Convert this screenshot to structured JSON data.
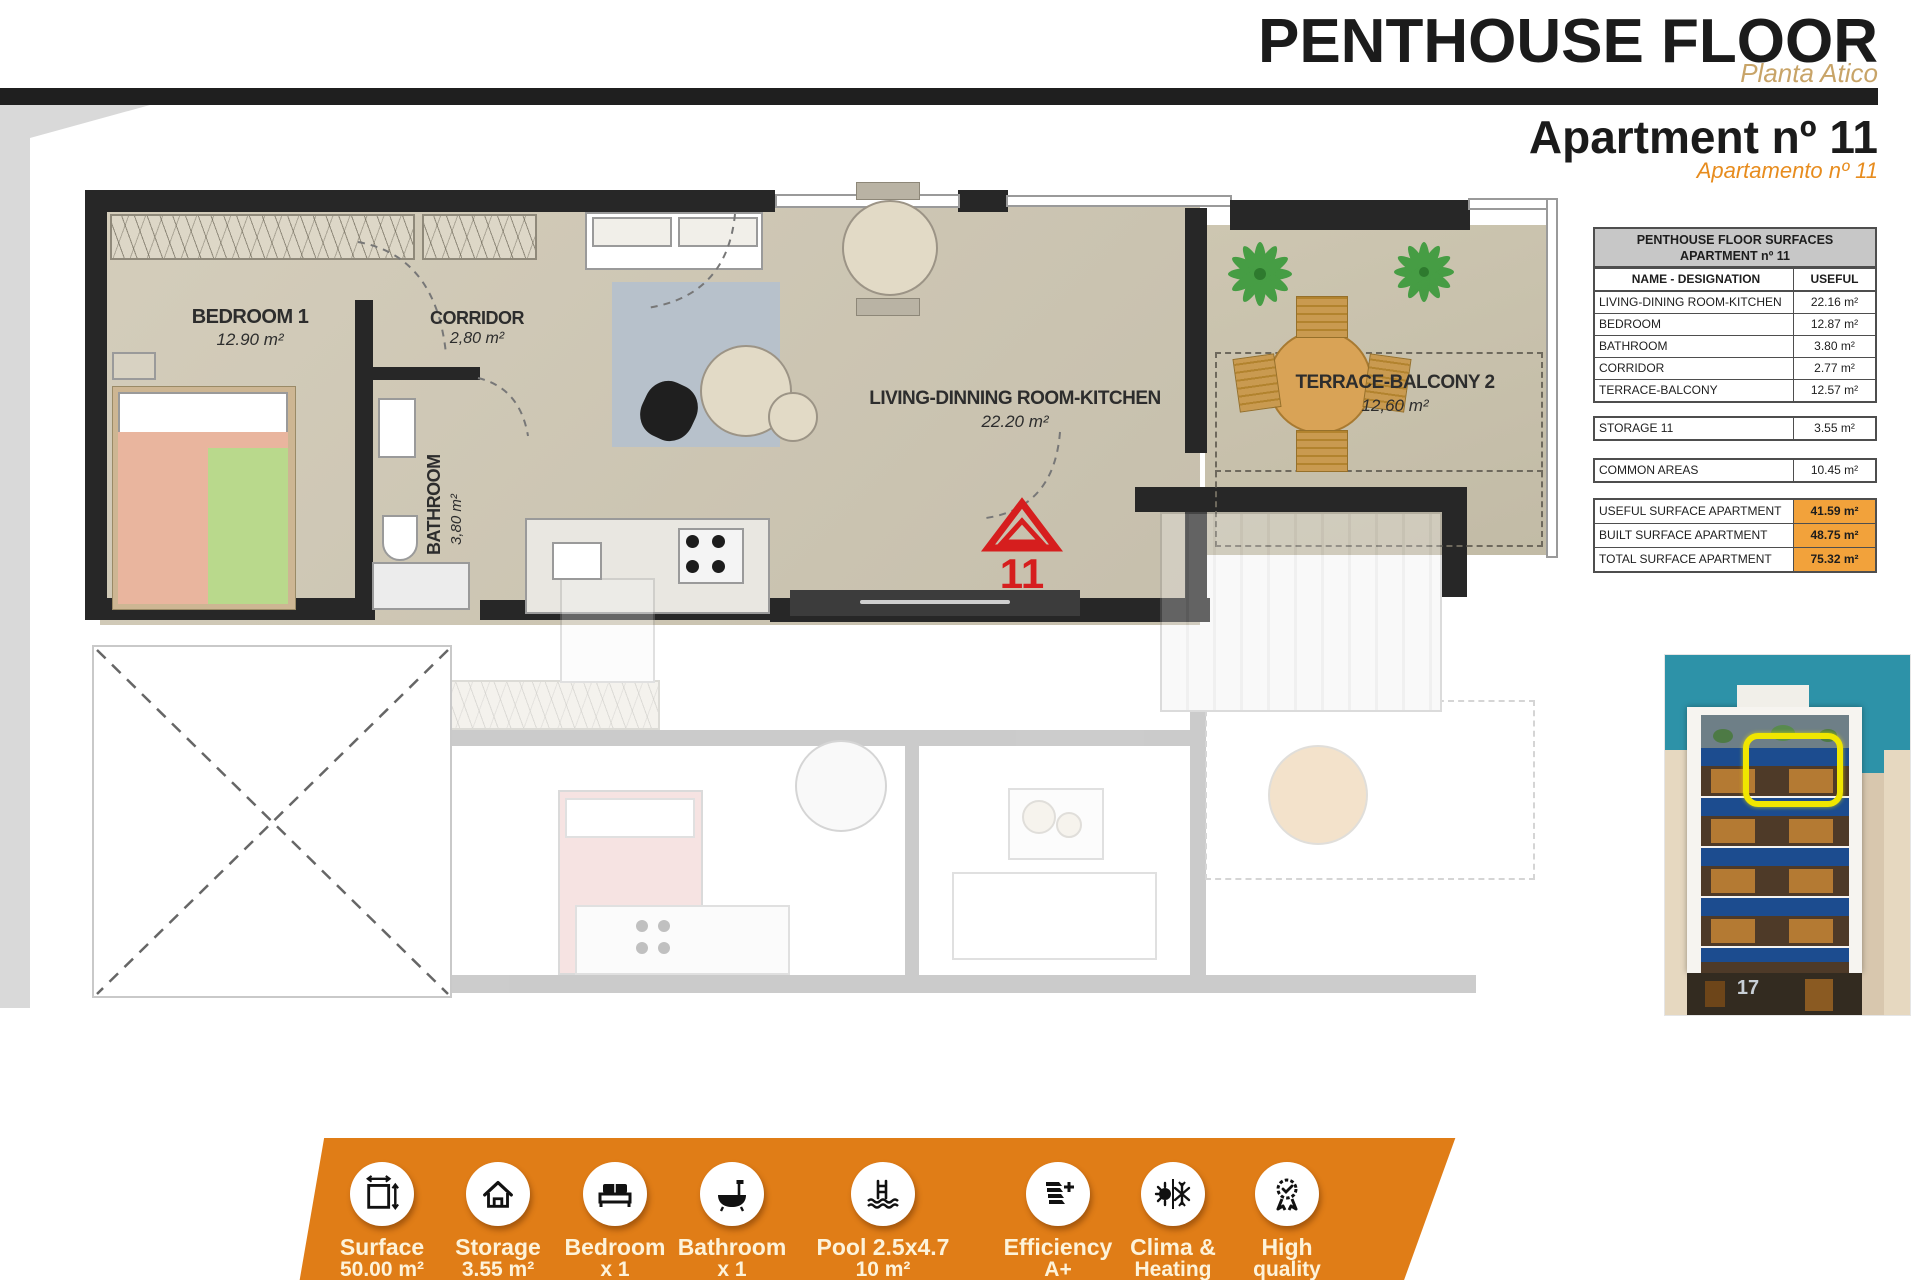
{
  "header": {
    "title": "PENTHOUSE FLOOR",
    "subtitle": "Planta Atico",
    "apartment_title": "Apartment nº 11",
    "apartment_subtitle": "Apartamento nº 11"
  },
  "floor_plan": {
    "rooms": [
      {
        "name": "BEDROOM 1",
        "area": "12.90 m²"
      },
      {
        "name": "CORRIDOR",
        "area": "2,80 m²"
      },
      {
        "name": "BATHROOM",
        "area": "3,80 m²"
      },
      {
        "name": "LIVING-DINNING ROOM-KITCHEN",
        "area": "22.20 m²"
      },
      {
        "name": "TERRACE-BALCONY 2",
        "area": "12,60 m²"
      }
    ],
    "entrance_marker": "11"
  },
  "surfaces_table": {
    "title_line1": "PENTHOUSE FLOOR SURFACES",
    "title_line2": "APARTMENT nº 11",
    "col_name": "NAME - DESIGNATION",
    "col_useful": "USEFUL",
    "rows": [
      {
        "name": "LIVING-DINING ROOM-KITCHEN",
        "value": "22.16 m²"
      },
      {
        "name": "BEDROOM",
        "value": "12.87 m²"
      },
      {
        "name": "BATHROOM",
        "value": "3.80 m²"
      },
      {
        "name": "CORRIDOR",
        "value": "2.77 m²"
      },
      {
        "name": "TERRACE-BALCONY",
        "value": "12.57 m²"
      }
    ],
    "storage_row": {
      "name": "STORAGE 11",
      "value": "3.55 m²"
    },
    "common_row": {
      "name": "COMMON AREAS",
      "value": "10.45 m²"
    },
    "summary_rows": [
      {
        "name": "USEFUL SURFACE APARTMENT",
        "value": "41.59 m²"
      },
      {
        "name": "BUILT SURFACE APARTMENT",
        "value": "48.75 m²"
      },
      {
        "name": "TOTAL SURFACE APARTMENT",
        "value": "75.32 m²"
      }
    ]
  },
  "building": {
    "street_number": "17"
  },
  "banner": {
    "items": [
      {
        "label": "Surface",
        "value": "50.00 m²"
      },
      {
        "label": "Storage",
        "value": "3.55 m²"
      },
      {
        "label": "Bedroom",
        "value": "x 1"
      },
      {
        "label": "Bathroom",
        "value": "x 1"
      },
      {
        "label": "Pool 2.5x4.7",
        "value": "10 m²"
      },
      {
        "label": "Efficiency",
        "value": "A+"
      },
      {
        "label": "Clima &",
        "value": "Heating"
      },
      {
        "label": "High",
        "value": "quality"
      }
    ]
  },
  "colors": {
    "accent_orange": "#e78c1e",
    "table_orange": "#f2a23b",
    "banner_orange": "#e07d17",
    "marker_red": "#d61e1e",
    "subtitle_tan": "#c8a468",
    "awning_blue": "#1c4c8f",
    "sky_teal": "#2d92a8",
    "highlight_yellow": "#f0e600"
  }
}
